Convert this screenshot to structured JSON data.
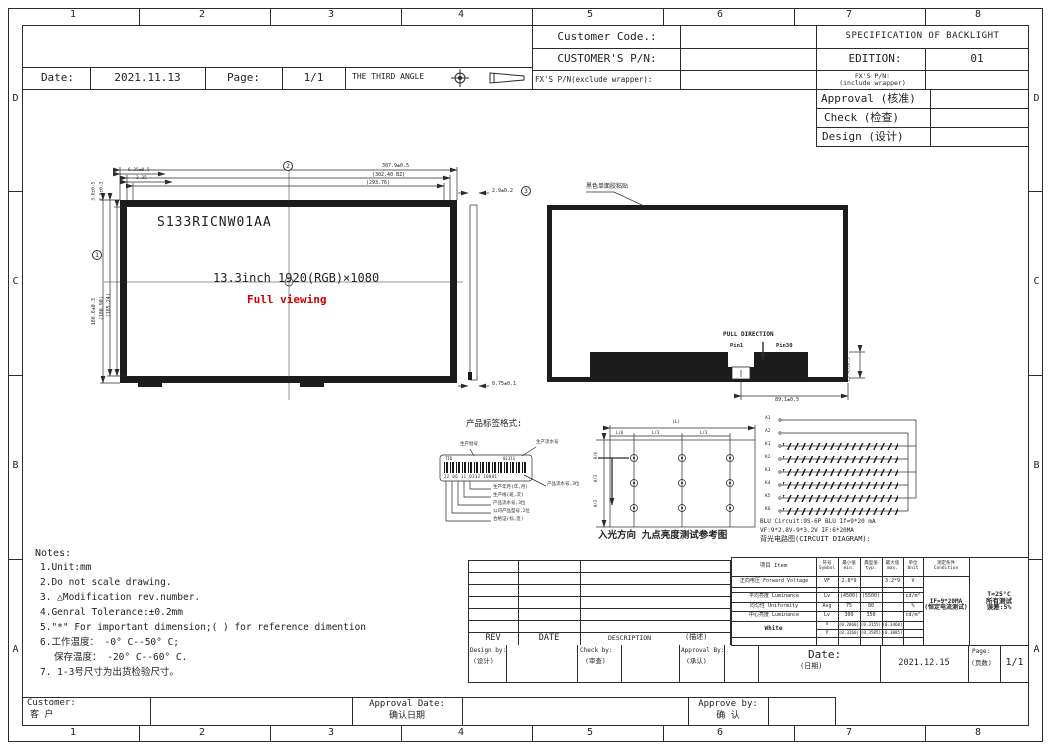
{
  "frame": {
    "top_numbers": [
      "1",
      "2",
      "3",
      "4",
      "5",
      "6",
      "7",
      "8"
    ],
    "bottom_numbers": [
      "1",
      "2",
      "3",
      "4",
      "5",
      "6",
      "7",
      "8"
    ],
    "side_letters": [
      "D",
      "C",
      "B",
      "A"
    ]
  },
  "header": {
    "customer_code_label": "Customer Code.:",
    "customers_pn_label": "CUSTOMER'S P/N:",
    "fx_pn_exclude_label": "FX'S P/N(exclude wrapper):",
    "spec_title": "SPECIFICATION OF BACKLIGHT",
    "edition_label": "EDITION:",
    "edition_value": "01",
    "fx_pn_include_label1": "FX'S P/N:",
    "fx_pn_include_label2": "(include wrapper)",
    "approval_label": "Approval (核准)",
    "check_label": "Check (检查)",
    "design_label": "Design (设计)",
    "date_label": "Date:",
    "date_value": "2021.11.13",
    "page_label": "Page:",
    "page_value": "1/1",
    "third_angle_label": "THE THIRD ANGLE"
  },
  "drawing": {
    "model": "S133RICNW01AA",
    "size_text": "13.3inch 1920(RGB)×1080",
    "full_viewing": "Full viewing",
    "front": {
      "width": "307.9±0.5",
      "width_bz": "(302.40 BZ)",
      "width_aa": "(293.76)",
      "off1": "6.35±0.5",
      "off2": "2.35",
      "height": "186.6±0.3",
      "height_bz": "(180.90)",
      "height_aa": "(165.24)",
      "vt1": "3.6±0.5",
      "vt2": "2.5±0.3",
      "mark_w": "2",
      "mark_h": "1"
    },
    "side": {
      "thickness": "2.9±0.2",
      "mark": "3",
      "bottom": "0.75±0.1"
    },
    "back": {
      "adhesive_note": "黑色单面胶粘贴",
      "pull_direction": "PULL DIRECTION",
      "pin1": "Pin1",
      "pin30": "Pin30",
      "fpc_height": "15.45±0.3",
      "fpc_width": "89.1±0.5"
    }
  },
  "label_format": {
    "title": "产品标签格式:",
    "tid": "TID",
    "code": "01311",
    "digits": "22 06 11 0312  10001",
    "leader_top": "生产批号",
    "leader_serial": "生产流水号",
    "leader_right": "产品流水号,3位",
    "s1": "生产年月(年,月)",
    "s2": "生产线(班,次)",
    "s3": "产品流水号,3位",
    "s4": "公司产品型号,2位",
    "s5": "合格证(标,签)"
  },
  "nine_point": {
    "caption": "入光方向  九点亮度测试参考图",
    "overall_l": "(L)",
    "seg1": "L/6",
    "seg2": "L/3",
    "seg3": "L/3",
    "overall_h": "(H)",
    "hseg1": "H/6",
    "hseg2": "H/3",
    "hseg3": "H/3"
  },
  "circuit": {
    "terminals": [
      "A1",
      "A2",
      "K1",
      "K2",
      "K3",
      "K4",
      "K5",
      "K6"
    ],
    "line1": "BLU Circuit:9S-6P BLU If=9*20 mA",
    "line2": "VF:9*2.8V-9*3.2V IF:6*20MA",
    "line3": "背光电路图(CIRCUIT DIAGRAM):"
  },
  "notes": {
    "title": "Notes:",
    "items": [
      "1.Unit:mm",
      "2.Do not scale drawing.",
      "3. △Modification rev.number.",
      "4.Genral Tolerance:±0.2mm",
      "5.\"*\" For important dimension;( ) for reference dimention",
      "6.工作温度：  -0° C--50° C;",
      "保存温度：  -20° C--60° C.",
      "7. 1-3号尺寸为出货检验尺寸。"
    ]
  },
  "rev_table": {
    "rev": "REV",
    "date": "DATE",
    "description": "DESCRIPTION",
    "description_cn": "(描述)"
  },
  "spec_table": {
    "headers": {
      "item_cn": "项目",
      "item_en": "Item",
      "symbol_cn": "符号",
      "symbol_en": "Symbol",
      "min_cn": "最小值",
      "min_en": "min.",
      "typ_cn": "典型值",
      "typ_en": "typ.",
      "max_cn": "最大值",
      "max_en": "max.",
      "unit_cn": "单位",
      "unit_en": "Unit",
      "cond_cn": "测定条件",
      "cond_en": "Condition"
    },
    "rows": [
      {
        "item_cn": "正向电压",
        "item_en": "Forward Voltage",
        "sym": "VF",
        "min": "2.8*9",
        "typ": "",
        "max": "3.2*9",
        "unit": "V"
      },
      {
        "item_cn": "平均亮度",
        "item_en": "Luminance",
        "sym": "Lv",
        "min": "(4500)",
        "typ": "(5500)",
        "max": "",
        "unit": "cd/m²"
      },
      {
        "item_cn": "均匀性",
        "item_en": "Uniformity",
        "sym": "Avg",
        "min": "75",
        "typ": "80",
        "max": "",
        "unit": "%"
      },
      {
        "item_cn": "中心亮度",
        "item_en": "Luminance",
        "sym": "Lv",
        "min": "300",
        "typ": "350",
        "max": "",
        "unit": "cd/m²"
      }
    ],
    "white": {
      "label": "White",
      "x": {
        "sym": "x",
        "min": "(0.2860)",
        "typ": "(0.3155)",
        "max": "(0.3460)"
      },
      "y": {
        "sym": "y",
        "min": "(0.3260)",
        "typ": "(0.3585)",
        "max": "(0.3885)"
      }
    },
    "condition1": "IF=9*20MA",
    "condition2": "(恒定电流测试)",
    "note1": "T=25°C",
    "note2": "所有测试",
    "note3": "误差:5%"
  },
  "bottom_strip": {
    "design_by": "Design by:",
    "design_cn": "(设计)",
    "check_by": "Check by:",
    "check_cn": "(审查)",
    "approval_by": "Approval By:",
    "approval_cn": "(承认)",
    "date_label": "Date:",
    "date_cn": "(日期)",
    "date_value": "2021.12.15",
    "page_label": "Page:",
    "page_cn": "(页数)",
    "page_value": "1/1"
  },
  "customer_strip": {
    "customer": "Customer:",
    "customer_cn": "客  户",
    "approval_date": "Approval Date:",
    "approval_date_cn": "确认日期",
    "approve_by": "Approve by:",
    "approve_cn": "确  认"
  }
}
